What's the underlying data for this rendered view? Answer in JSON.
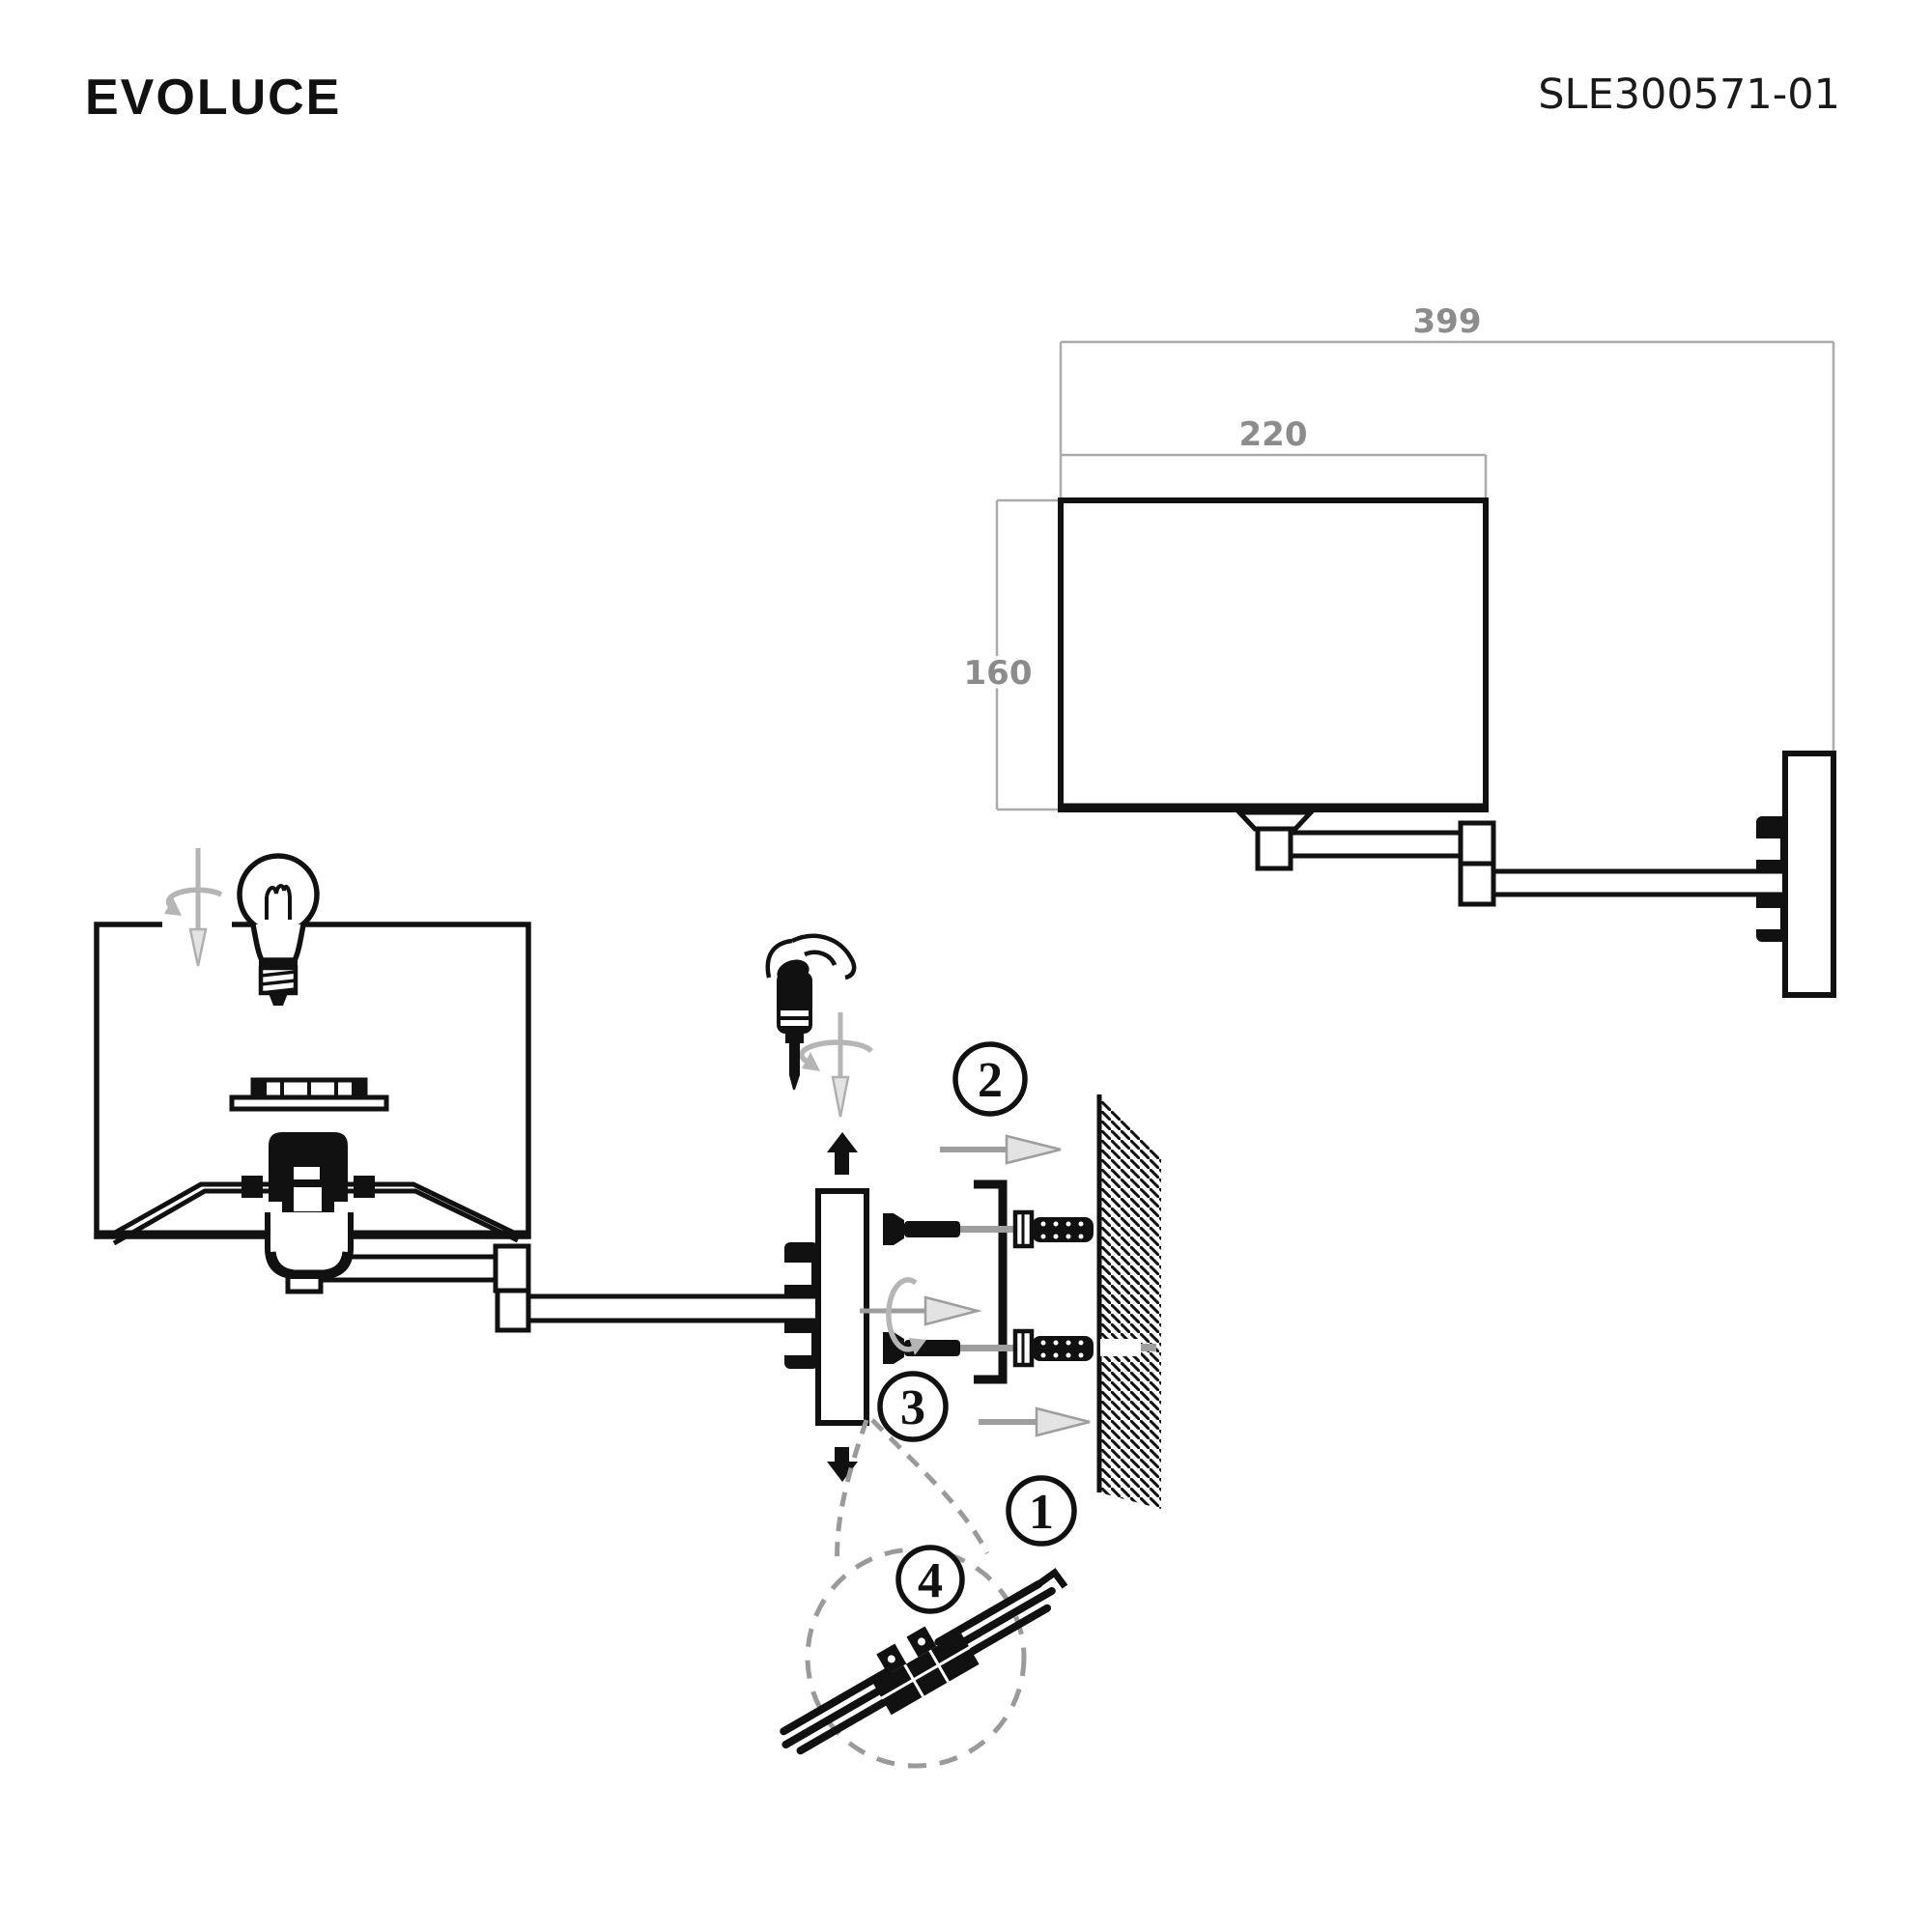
{
  "header": {
    "brand": "EVOLUCE",
    "model": "SLE300571-01"
  },
  "dimensions": {
    "total_projection": "399",
    "shade_width": "220",
    "shade_height": "160"
  },
  "steps": {
    "step_1": "1",
    "step_2": "2",
    "step_3": "3",
    "step_4": "4"
  },
  "colors": {
    "line": "#111111",
    "dimension_gray": "#8c8c8c",
    "symbol_gray": "#b5b5b5",
    "arrow_gray": "#9e9e9e",
    "arrow_fill": "#e3e3e3",
    "background": "#ffffff"
  }
}
